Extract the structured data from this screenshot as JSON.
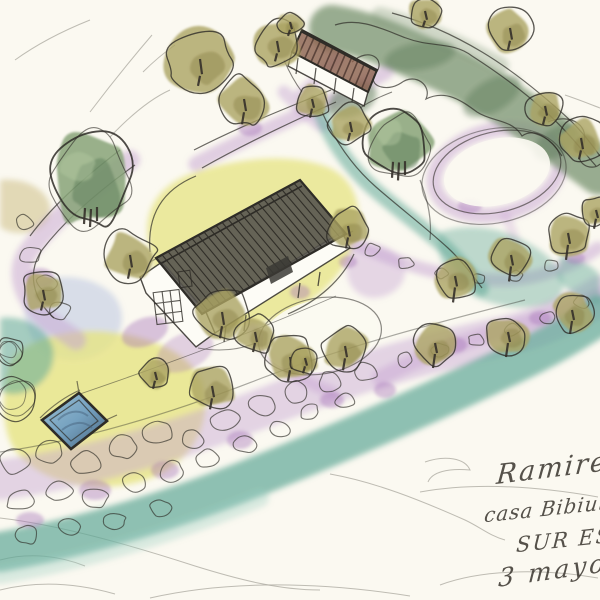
{
  "artwork": {
    "type": "watercolor and ink garden plan sketch, aerial perspective",
    "handwriting": {
      "line1": "Ramirez",
      "line2": "casa Bibiuta",
      "line3": "SUR ES",
      "line4": "3 mayo"
    }
  },
  "palette": {
    "paper": "#fbf9f1",
    "pencil": "#a9a79d",
    "ink": "#2e2c27",
    "lawn": "#e6e382",
    "lawn_light": "#f0eeab",
    "path_purple": "#c6a3d2",
    "path_purple_dark": "#a671b8",
    "water_teal": "#5fa897",
    "water_teal_light": "#9ccfbf",
    "hedge_green": "#7f9878",
    "hedge_green_dark": "#647f60",
    "tree_green": "#87a378",
    "tree_green_dark": "#5e7d5a",
    "tree_green_light": "#b3c8a0",
    "tree_olive": "#aba463",
    "tree_olive_dark": "#8a8147",
    "roof_main": "#57544e",
    "roof_barn": "#8a5f4c",
    "pool_water": "#76a2c0",
    "pool_water_dark": "#47637e",
    "wash_blue": "#aebbdd",
    "wash_tan": "#c9b97c"
  },
  "scene": {
    "buildings": [
      {
        "name": "main house",
        "roof": "dark hatched gable roof"
      },
      {
        "name": "outbuilding",
        "roof": "brown hatched roof"
      }
    ],
    "pond": {
      "shape": "rectangular pool",
      "color": "blue"
    },
    "trees_olive": [
      [
        200,
        61,
        33,
        10
      ],
      [
        277,
        43,
        23,
        8
      ],
      [
        244,
        101,
        25,
        12
      ],
      [
        312,
        101,
        17,
        9
      ],
      [
        290,
        24,
        13,
        6
      ],
      [
        425,
        13,
        17,
        6
      ],
      [
        510,
        30,
        24,
        9
      ],
      [
        545,
        108,
        19,
        8
      ],
      [
        581,
        140,
        23,
        9
      ],
      [
        130,
        257,
        26,
        10
      ],
      [
        43,
        292,
        21,
        9
      ],
      [
        350,
        124,
        20,
        8
      ],
      [
        348,
        228,
        21,
        11
      ],
      [
        222,
        314,
        27,
        12
      ],
      [
        255,
        334,
        20,
        9
      ],
      [
        290,
        359,
        25,
        11
      ],
      [
        345,
        348,
        23,
        12
      ],
      [
        212,
        388,
        23,
        11
      ],
      [
        155,
        374,
        15,
        8
      ],
      [
        305,
        360,
        14,
        7
      ],
      [
        455,
        278,
        21,
        15
      ],
      [
        511,
        257,
        21,
        15
      ],
      [
        568,
        235,
        22,
        15
      ],
      [
        596,
        212,
        15,
        10
      ],
      [
        435,
        345,
        20,
        14
      ],
      [
        508,
        334,
        20,
        14
      ],
      [
        572,
        312,
        20,
        13
      ]
    ],
    "trees_green": [
      [
        90,
        178,
        40,
        1.25
      ],
      [
        398,
        142,
        33,
        1
      ]
    ],
    "scribble_trees": [
      [
        14,
        398,
        25
      ],
      [
        10,
        352,
        15
      ]
    ],
    "boulders": [
      [
        15,
        462,
        16
      ],
      [
        50,
        452,
        14
      ],
      [
        86,
        462,
        15
      ],
      [
        122,
        447,
        15
      ],
      [
        158,
        432,
        16
      ],
      [
        192,
        440,
        12
      ],
      [
        226,
        420,
        15
      ],
      [
        262,
        405,
        14
      ],
      [
        297,
        392,
        14
      ],
      [
        330,
        382,
        13
      ],
      [
        366,
        372,
        12
      ],
      [
        20,
        500,
        14
      ],
      [
        58,
        492,
        13
      ],
      [
        96,
        498,
        13
      ],
      [
        134,
        482,
        12
      ],
      [
        172,
        472,
        13
      ],
      [
        208,
        458,
        12
      ],
      [
        244,
        444,
        12
      ],
      [
        280,
        430,
        11
      ],
      [
        310,
        412,
        10
      ],
      [
        345,
        400,
        10
      ],
      [
        25,
        535,
        12
      ],
      [
        70,
        528,
        11
      ],
      [
        115,
        520,
        11
      ],
      [
        160,
        508,
        11
      ],
      [
        405,
        360,
        9
      ],
      [
        440,
        350,
        9
      ],
      [
        476,
        340,
        8
      ],
      [
        512,
        330,
        8
      ],
      [
        548,
        318,
        8
      ],
      [
        582,
        302,
        8
      ],
      [
        30,
        254,
        11
      ],
      [
        46,
        284,
        10
      ],
      [
        61,
        310,
        11
      ],
      [
        24,
        222,
        9
      ],
      [
        372,
        250,
        8
      ],
      [
        406,
        263,
        8
      ],
      [
        441,
        273,
        7
      ],
      [
        479,
        279,
        7
      ],
      [
        516,
        276,
        7
      ],
      [
        551,
        266,
        7
      ]
    ]
  }
}
